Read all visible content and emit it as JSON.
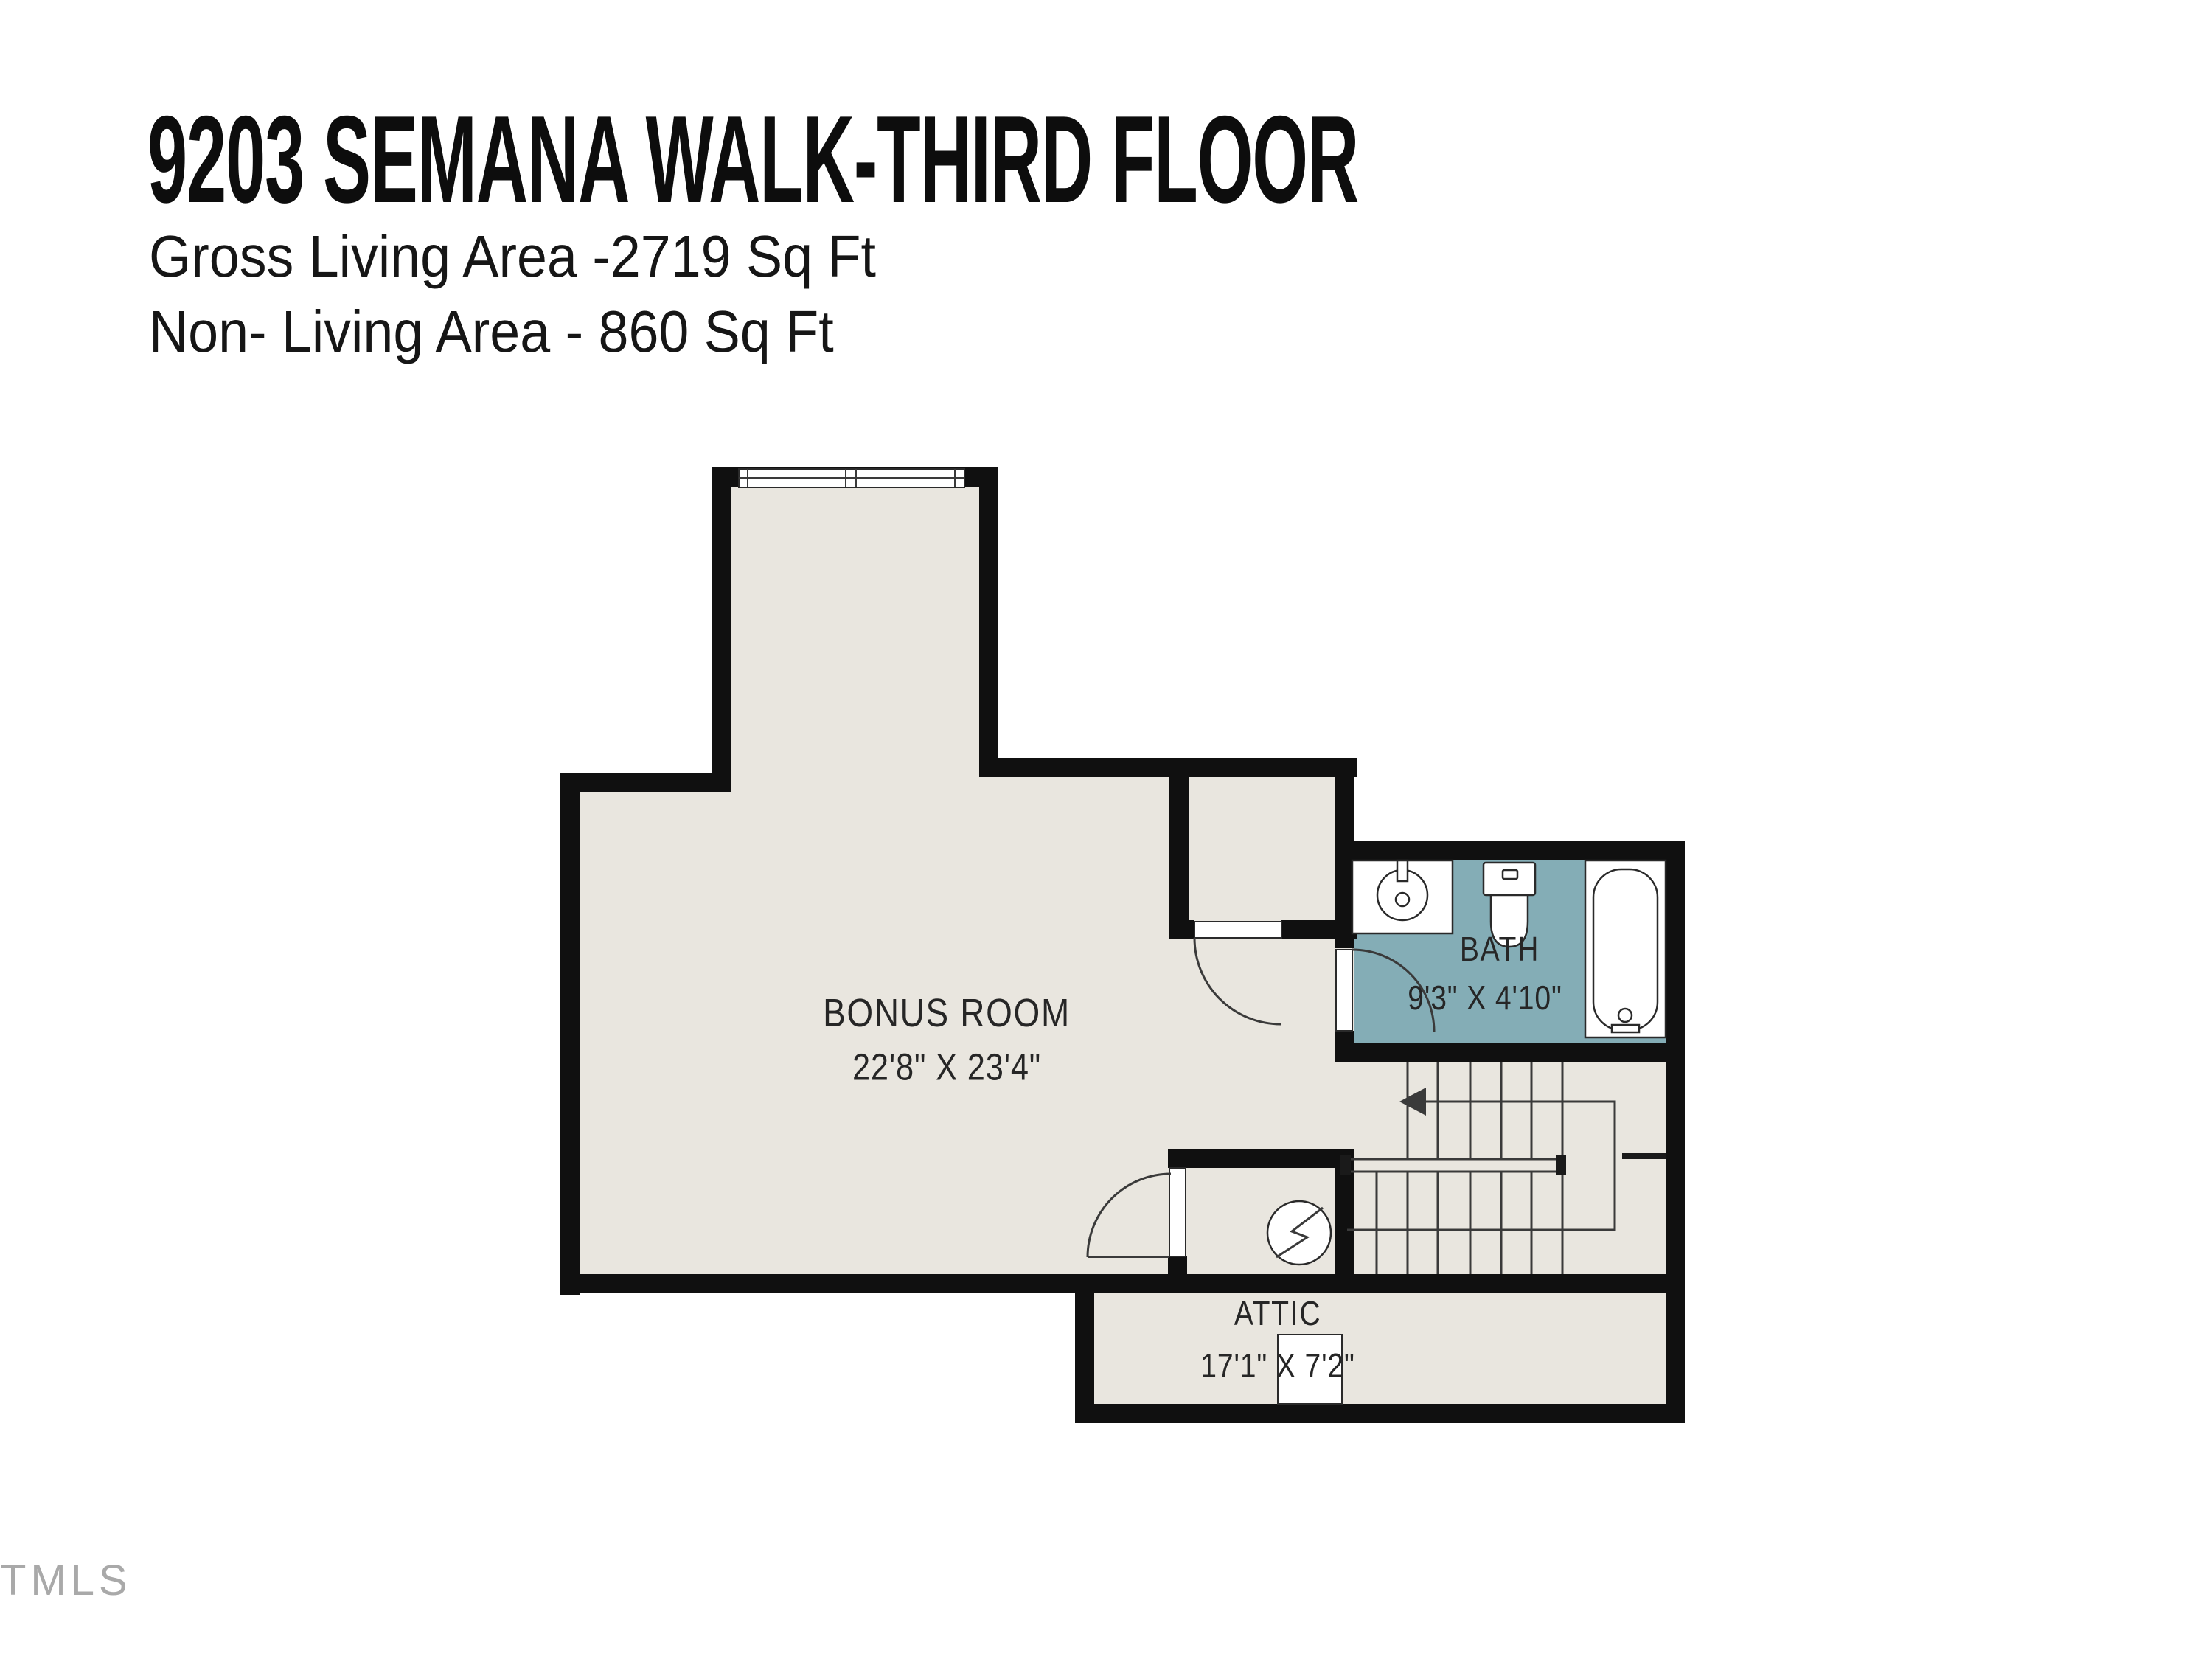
{
  "header": {
    "title": "9203 SEMANA WALK-THIRD FLOOR",
    "subtitle1": "Gross Living Area -2719 Sq Ft",
    "subtitle2": "Non- Living Area - 860 Sq Ft"
  },
  "rooms": {
    "bonus": {
      "name": "BONUS ROOM",
      "dims": "22'8\" X 23'4\""
    },
    "bath": {
      "name": "BATH",
      "dims": "9'3\" X 4'10\""
    },
    "attic": {
      "name": "ATTIC",
      "dims": "17'1\" X 7'2\""
    }
  },
  "symbols": {
    "electrical": "electrical-panel-symbol",
    "stairs_direction": "up-arrow"
  },
  "watermark": "TMLS",
  "colors": {
    "wall": "#101010",
    "floor": "#e9e6df",
    "bath_floor": "#84adb6",
    "line": "#3a3a3a",
    "text": "#262626",
    "watermark": "#a9a9a9"
  }
}
